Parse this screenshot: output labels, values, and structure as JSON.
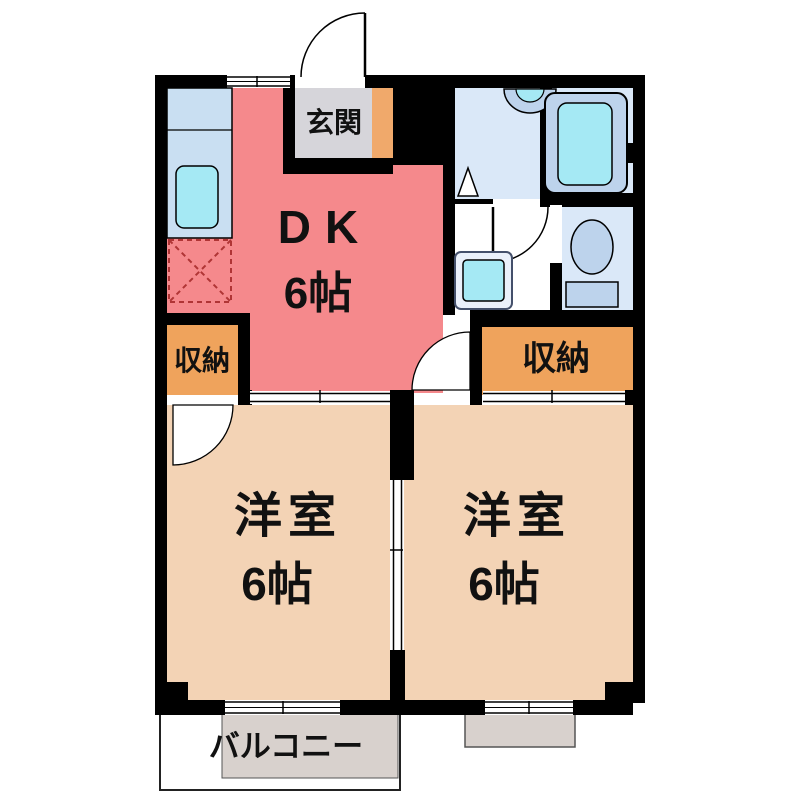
{
  "plan": {
    "type": "2DK",
    "entrance": {
      "label": "玄関"
    },
    "dk": {
      "name": "DK",
      "size": "6帖"
    },
    "closet_left": {
      "label": "収納"
    },
    "closet_right": {
      "label": "収納"
    },
    "room_left": {
      "name": "洋室",
      "size": "6帖"
    },
    "room_right": {
      "name": "洋室",
      "size": "6帖"
    },
    "balcony": {
      "label": "バルコニー"
    },
    "fixtures": {
      "kitchen_sink": "kitchen-sink",
      "refrigerator_space": "refrigerator-space",
      "washbasin": "washbasin",
      "bathtub": "bathtub",
      "toilet": "toilet",
      "washing_machine_space": "washing-machine-space"
    }
  },
  "colors": {
    "wall": "#000000",
    "dk": "#F5898C",
    "room": "#F3D3B5",
    "closet": "#EFA35C",
    "entrance": "#D6D5DA",
    "shoe_cabinet": "#F0A96B",
    "water_room": "#DAE8F8",
    "fixture_blue": "#BDD3EC",
    "fixture_cyan": "#A5E9F4",
    "counter": "#C9DFF2",
    "balcony": "#D8D1CD"
  }
}
